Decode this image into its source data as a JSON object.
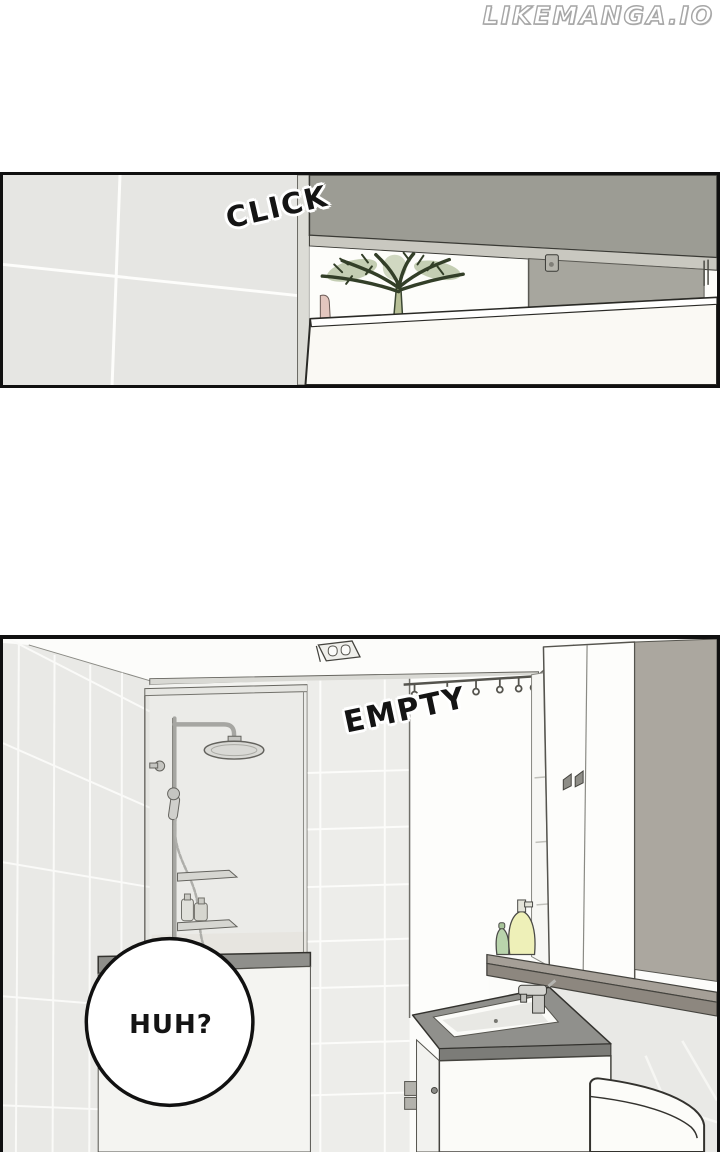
{
  "page": {
    "kind": "webtoon comic page",
    "background": "#ffffff"
  },
  "watermark": {
    "text": "LIKEMANGA.IO"
  },
  "panel1": {
    "sfx": "CLICK",
    "scene": "bathroom door ajar, plant visible through gap above door",
    "colors": {
      "tile_wall": "#e6e6e3",
      "upper_wall": "#9c9c94",
      "door_frame": "#c9c8c0",
      "door": "#faf9f4",
      "plant_green": "#8ba06b"
    }
  },
  "panel2": {
    "sfx": "EMPTY",
    "speech_bubble": {
      "text": "HUH?"
    },
    "scene": "empty bathroom: shower with glass partition, curtain rod, mirror cabinet, shelf with bottles, sink vanity, toilet tank",
    "colors": {
      "wall_tile": "#e9e9e6",
      "accent_wall": "#aba79f",
      "shelf": "#8d877f",
      "counter": "#90908c",
      "bottle_yellow": "#eef0b8",
      "bottle_green": "#b9d4ac"
    }
  }
}
